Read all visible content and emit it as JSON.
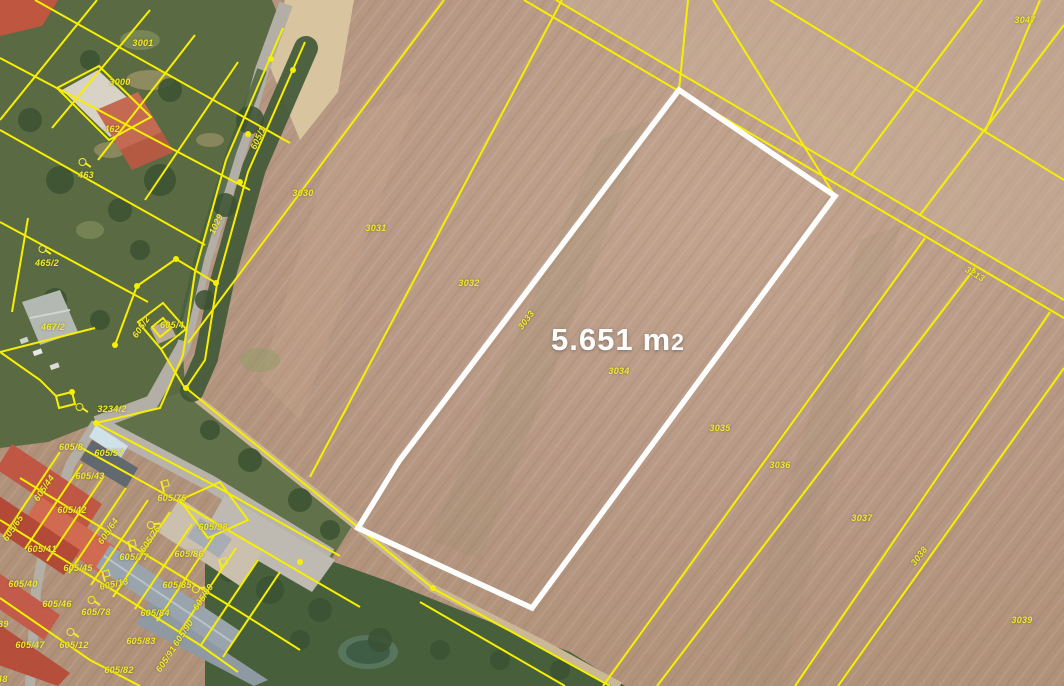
{
  "map": {
    "title": "cadastral-aerial-map",
    "highlight": {
      "area_value": "5.651",
      "area_unit_letter": "m",
      "area_unit_digit": "2",
      "outline_color": "#ffffff"
    },
    "colors": {
      "cadastral_yellow": "#f7ef00",
      "label_yellow": "#efe832",
      "highlight_white": "#ffffff",
      "field_brown": "#b79884",
      "vegetation_green": "#5a6a42",
      "roof_red": "#c05745",
      "roof_gray": "#9aa4ac",
      "road_gray": "#b3aea6"
    },
    "icons_legend": {
      "hook": "circle-with-tail cadastral symbol",
      "flag": "flag-on-pole cadastral symbol"
    },
    "parcel_labels": [
      {
        "text": "3001",
        "x": 143,
        "y": 43,
        "rot": 0
      },
      {
        "text": "3000",
        "x": 120,
        "y": 82,
        "rot": 0
      },
      {
        "text": "462",
        "x": 112,
        "y": 129,
        "rot": 0
      },
      {
        "text": "463",
        "x": 86,
        "y": 175,
        "rot": 0
      },
      {
        "text": "465/2",
        "x": 47,
        "y": 263,
        "rot": 0
      },
      {
        "text": "467/2",
        "x": 53,
        "y": 327,
        "rot": 0
      },
      {
        "text": "605/4",
        "x": 172,
        "y": 325,
        "rot": 0
      },
      {
        "text": "605/2",
        "x": 141,
        "y": 327,
        "rot": -56
      },
      {
        "text": "605/1",
        "x": 258,
        "y": 138,
        "rot": -65
      },
      {
        "text": "1029",
        "x": 216,
        "y": 224,
        "rot": -65
      },
      {
        "text": "3030",
        "x": 303,
        "y": 193,
        "rot": 0
      },
      {
        "text": "3031",
        "x": 376,
        "y": 228,
        "rot": 0
      },
      {
        "text": "3032",
        "x": 469,
        "y": 283,
        "rot": 0
      },
      {
        "text": "3033",
        "x": 526,
        "y": 320,
        "rot": -53
      },
      {
        "text": "3034",
        "x": 619,
        "y": 371,
        "rot": 0
      },
      {
        "text": "3035",
        "x": 720,
        "y": 428,
        "rot": 0
      },
      {
        "text": "3036",
        "x": 780,
        "y": 465,
        "rot": 0
      },
      {
        "text": "3037",
        "x": 862,
        "y": 518,
        "rot": 0
      },
      {
        "text": "3038",
        "x": 919,
        "y": 556,
        "rot": -53
      },
      {
        "text": "3039",
        "x": 1022,
        "y": 620,
        "rot": 0
      },
      {
        "text": "3047",
        "x": 1025,
        "y": 20,
        "rot": 0
      },
      {
        "text": "3213",
        "x": 975,
        "y": 274,
        "rot": 31
      },
      {
        "text": "3234/2",
        "x": 112,
        "y": 409,
        "rot": 0
      },
      {
        "text": "605/8",
        "x": 71,
        "y": 447,
        "rot": 0
      },
      {
        "text": "605/57",
        "x": 109,
        "y": 453,
        "rot": 0
      },
      {
        "text": "605/43",
        "x": 90,
        "y": 476,
        "rot": 0
      },
      {
        "text": "605/44",
        "x": 44,
        "y": 488,
        "rot": -56
      },
      {
        "text": "605/42",
        "x": 72,
        "y": 510,
        "rot": 0
      },
      {
        "text": "605/65",
        "x": 13,
        "y": 528,
        "rot": -56
      },
      {
        "text": "605/41",
        "x": 42,
        "y": 549,
        "rot": 0
      },
      {
        "text": "605/45",
        "x": 78,
        "y": 568,
        "rot": 0
      },
      {
        "text": "605/40",
        "x": 23,
        "y": 584,
        "rot": 0
      },
      {
        "text": "605/64",
        "x": 108,
        "y": 531,
        "rot": -56
      },
      {
        "text": "605/76",
        "x": 150,
        "y": 539,
        "rot": -56
      },
      {
        "text": "605/77",
        "x": 134,
        "y": 557,
        "rot": 0
      },
      {
        "text": "605/13",
        "x": 114,
        "y": 584,
        "rot": -12
      },
      {
        "text": "605/75",
        "x": 172,
        "y": 498,
        "rot": 0
      },
      {
        "text": "605/98",
        "x": 213,
        "y": 527,
        "rot": 0
      },
      {
        "text": "605/86",
        "x": 189,
        "y": 554,
        "rot": 0
      },
      {
        "text": "605/85",
        "x": 177,
        "y": 585,
        "rot": 0
      },
      {
        "text": "605/84",
        "x": 155,
        "y": 613,
        "rot": 0
      },
      {
        "text": "605/89",
        "x": 203,
        "y": 597,
        "rot": -56
      },
      {
        "text": "605/90",
        "x": 183,
        "y": 633,
        "rot": -56
      },
      {
        "text": "605/91",
        "x": 166,
        "y": 659,
        "rot": -56
      },
      {
        "text": "605/46",
        "x": 57,
        "y": 604,
        "rot": 0
      },
      {
        "text": "605/78",
        "x": 96,
        "y": 612,
        "rot": 0
      },
      {
        "text": "605/47",
        "x": 30,
        "y": 645,
        "rot": 0
      },
      {
        "text": "605/12",
        "x": 74,
        "y": 645,
        "rot": 0
      },
      {
        "text": "605/83",
        "x": 141,
        "y": 641,
        "rot": 0
      },
      {
        "text": "605/82",
        "x": 119,
        "y": 670,
        "rot": 0
      },
      {
        "text": "605/39",
        "x": -6,
        "y": 624,
        "rot": 0
      },
      {
        "text": "605/48",
        "x": -7,
        "y": 679,
        "rot": 0
      }
    ],
    "point_symbols": [
      {
        "type": "hook",
        "x": 85,
        "y": 164,
        "rot": 0
      },
      {
        "type": "hook",
        "x": 45,
        "y": 251,
        "rot": 0
      },
      {
        "type": "hook",
        "x": 82,
        "y": 409,
        "rot": 0
      },
      {
        "type": "hook",
        "x": 94,
        "y": 602,
        "rot": 0
      },
      {
        "type": "hook",
        "x": 73,
        "y": 634,
        "rot": 0
      },
      {
        "type": "hook",
        "x": 199,
        "y": 589,
        "rot": -40
      },
      {
        "type": "hook",
        "x": 154,
        "y": 525,
        "rot": -40
      },
      {
        "type": "flag",
        "x": 131,
        "y": 546,
        "rot": -15
      },
      {
        "type": "flag",
        "x": 105,
        "y": 576,
        "rot": -15
      },
      {
        "type": "flag",
        "x": 222,
        "y": 564,
        "rot": -15
      },
      {
        "type": "flag",
        "x": 164,
        "y": 486,
        "rot": -15
      }
    ]
  }
}
